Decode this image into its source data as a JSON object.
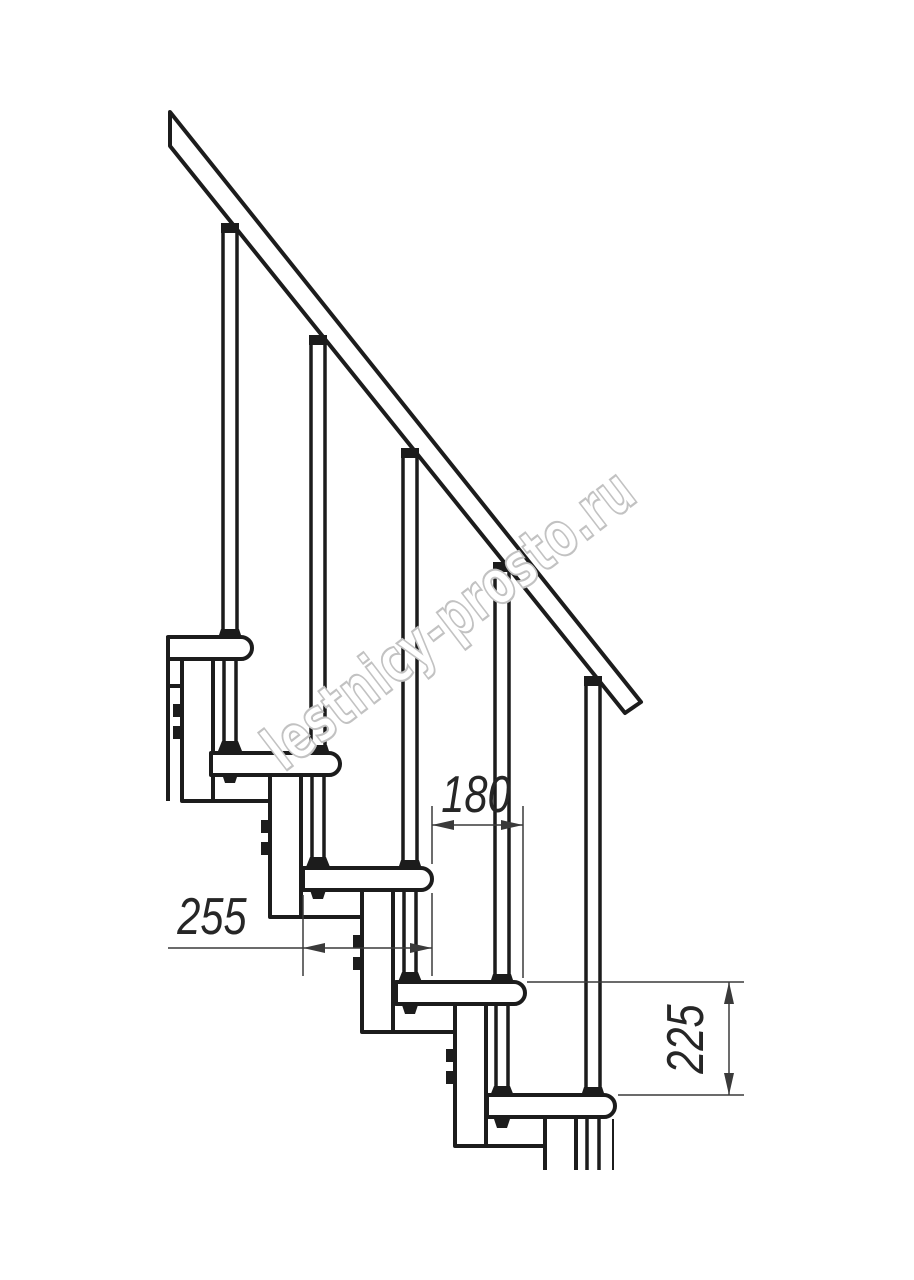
{
  "watermark": "lestnicy-prosto.ru",
  "dimensions": {
    "tread_depth": "255",
    "step_run": "180",
    "riser_height": "225"
  },
  "colors": {
    "line": "#1c1c1c",
    "dimension": "#3a3a3a",
    "watermark_outline": "#c2c2c2",
    "background": "#ffffff"
  }
}
